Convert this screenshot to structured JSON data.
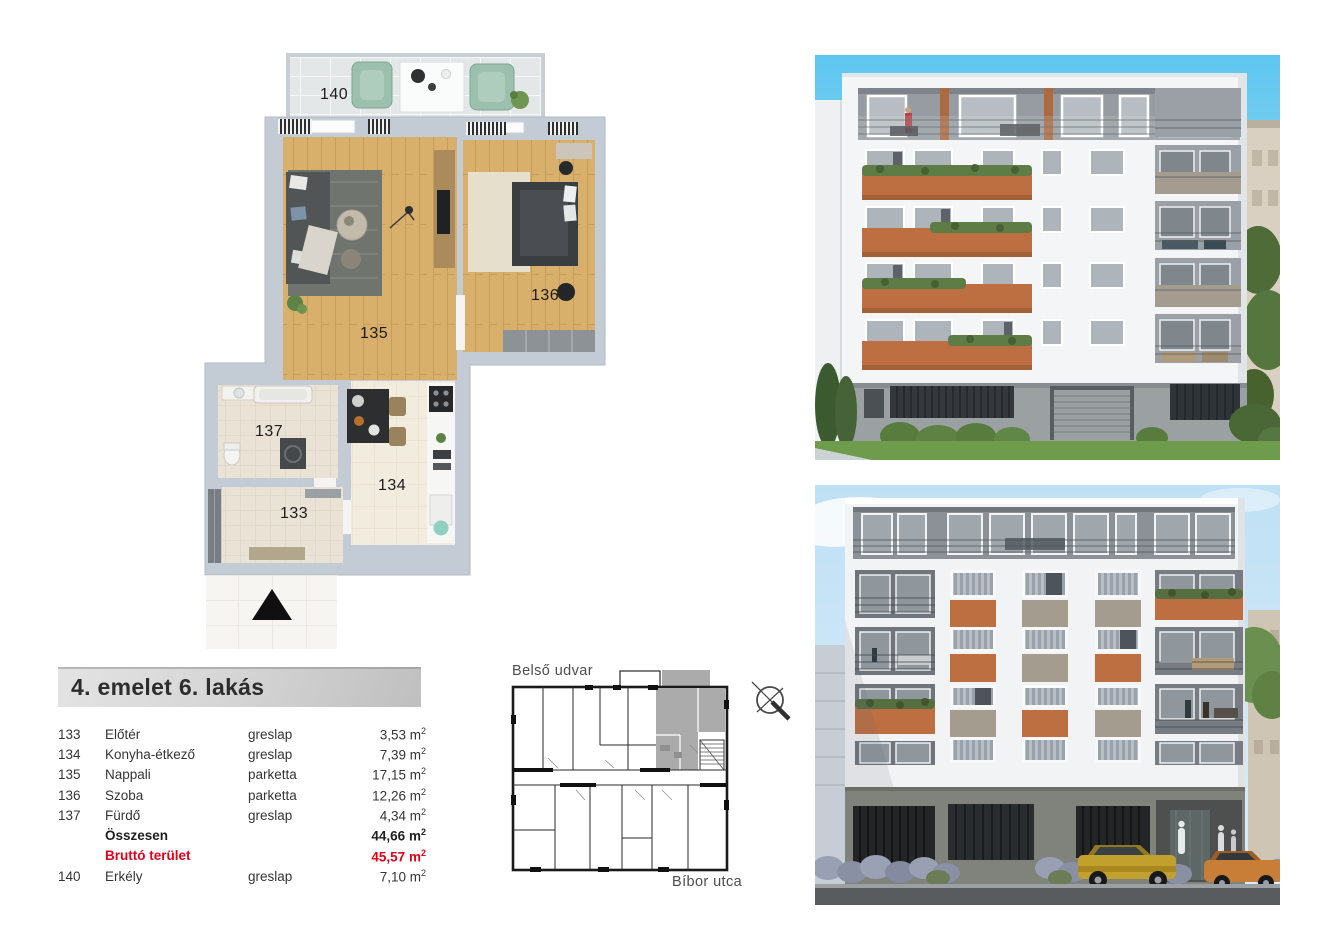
{
  "unit_info": {
    "title": "4. emelet 6. lakás",
    "rows": [
      {
        "num": "133",
        "name": "Előtér",
        "finish": "greslap",
        "area": "3,53"
      },
      {
        "num": "134",
        "name": "Konyha-étkező",
        "finish": "greslap",
        "area": "7,39"
      },
      {
        "num": "135",
        "name": "Nappali",
        "finish": "parketta",
        "area": "17,15"
      },
      {
        "num": "136",
        "name": "Szoba",
        "finish": "parketta",
        "area": "12,26"
      },
      {
        "num": "137",
        "name": "Fürdő",
        "finish": "greslap",
        "area": "4,34"
      },
      {
        "num": "",
        "name": "Összesen",
        "finish": "",
        "area": "44,66"
      },
      {
        "num": "",
        "name": "Bruttó terület",
        "finish": "",
        "area": "45,57"
      },
      {
        "num": "140",
        "name": "Erkély",
        "finish": "greslap",
        "area": "7,10"
      }
    ],
    "area_unit": "m",
    "area_sup": "2"
  },
  "floorplan": {
    "rooms": {
      "r140": "140",
      "r135": "135",
      "r136": "136",
      "r137": "137",
      "r134": "134",
      "r133": "133"
    }
  },
  "keyplan": {
    "top_label": "Belső udvar",
    "bottom_label": "Bíbor utca"
  },
  "colors": {
    "accent_red": "#e2001a",
    "balcony_orange": "#bd6f42",
    "panel_taupe": "#a49c8f",
    "wall_gray": "#c3cbd4",
    "sky_blue": "#5ec6ef",
    "highlight_gray": "#ababab"
  }
}
